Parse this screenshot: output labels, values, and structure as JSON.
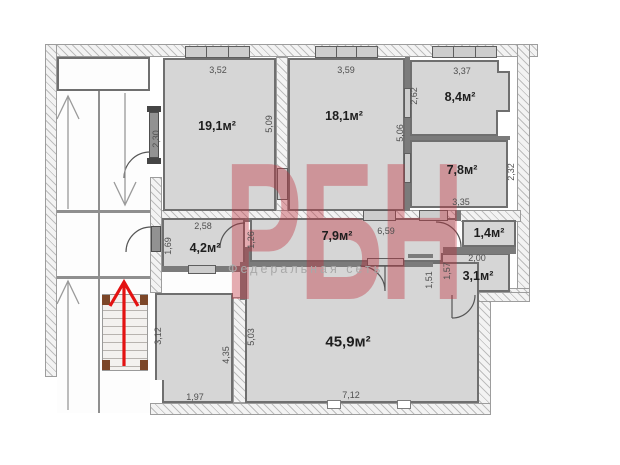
{
  "watermark": {
    "logo": "РБН",
    "tagline": "Федеральная сеть",
    "color": "#c1313e"
  },
  "plan": {
    "rooms": [
      {
        "key": "room-19-1",
        "area": "19,1м²"
      },
      {
        "key": "room-18-1",
        "area": "18,1м²"
      },
      {
        "key": "room-8-4",
        "area": "8,4м²"
      },
      {
        "key": "room-7-8",
        "area": "7,8м²"
      },
      {
        "key": "room-4-2",
        "area": "4,2м²"
      },
      {
        "key": "room-7-9",
        "area": "7,9м²"
      },
      {
        "key": "room-1-4",
        "area": "1,4м²"
      },
      {
        "key": "room-3-1",
        "area": "3,1м²"
      },
      {
        "key": "room-45-9",
        "area": "45,9м²"
      }
    ],
    "dimensions": [
      {
        "key": "dim-3-52",
        "text": "3,52"
      },
      {
        "key": "dim-3-59",
        "text": "3,59"
      },
      {
        "key": "dim-3-37",
        "text": "3,37"
      },
      {
        "key": "dim-2-30",
        "text": "2,30"
      },
      {
        "key": "dim-5-09",
        "text": "5,09"
      },
      {
        "key": "dim-2-62",
        "text": "2,62"
      },
      {
        "key": "dim-5-06",
        "text": "5,06"
      },
      {
        "key": "dim-2-32",
        "text": "2,32"
      },
      {
        "key": "dim-3-35",
        "text": "3,35"
      },
      {
        "key": "dim-2-58",
        "text": "2,58"
      },
      {
        "key": "dim-1-69",
        "text": "1,69"
      },
      {
        "key": "dim-1-26",
        "text": "1,26"
      },
      {
        "key": "dim-6-59",
        "text": "6,59"
      },
      {
        "key": "dim-2-00",
        "text": "2,00"
      },
      {
        "key": "dim-1-57",
        "text": "1,57"
      },
      {
        "key": "dim-1-51",
        "text": "1,51"
      },
      {
        "key": "dim-3-12",
        "text": "3,12"
      },
      {
        "key": "dim-5-03",
        "text": "5,03"
      },
      {
        "key": "dim-4-35",
        "text": "4,35"
      },
      {
        "key": "dim-1-97",
        "text": "1,97"
      },
      {
        "key": "dim-7-12",
        "text": "7,12"
      }
    ]
  }
}
